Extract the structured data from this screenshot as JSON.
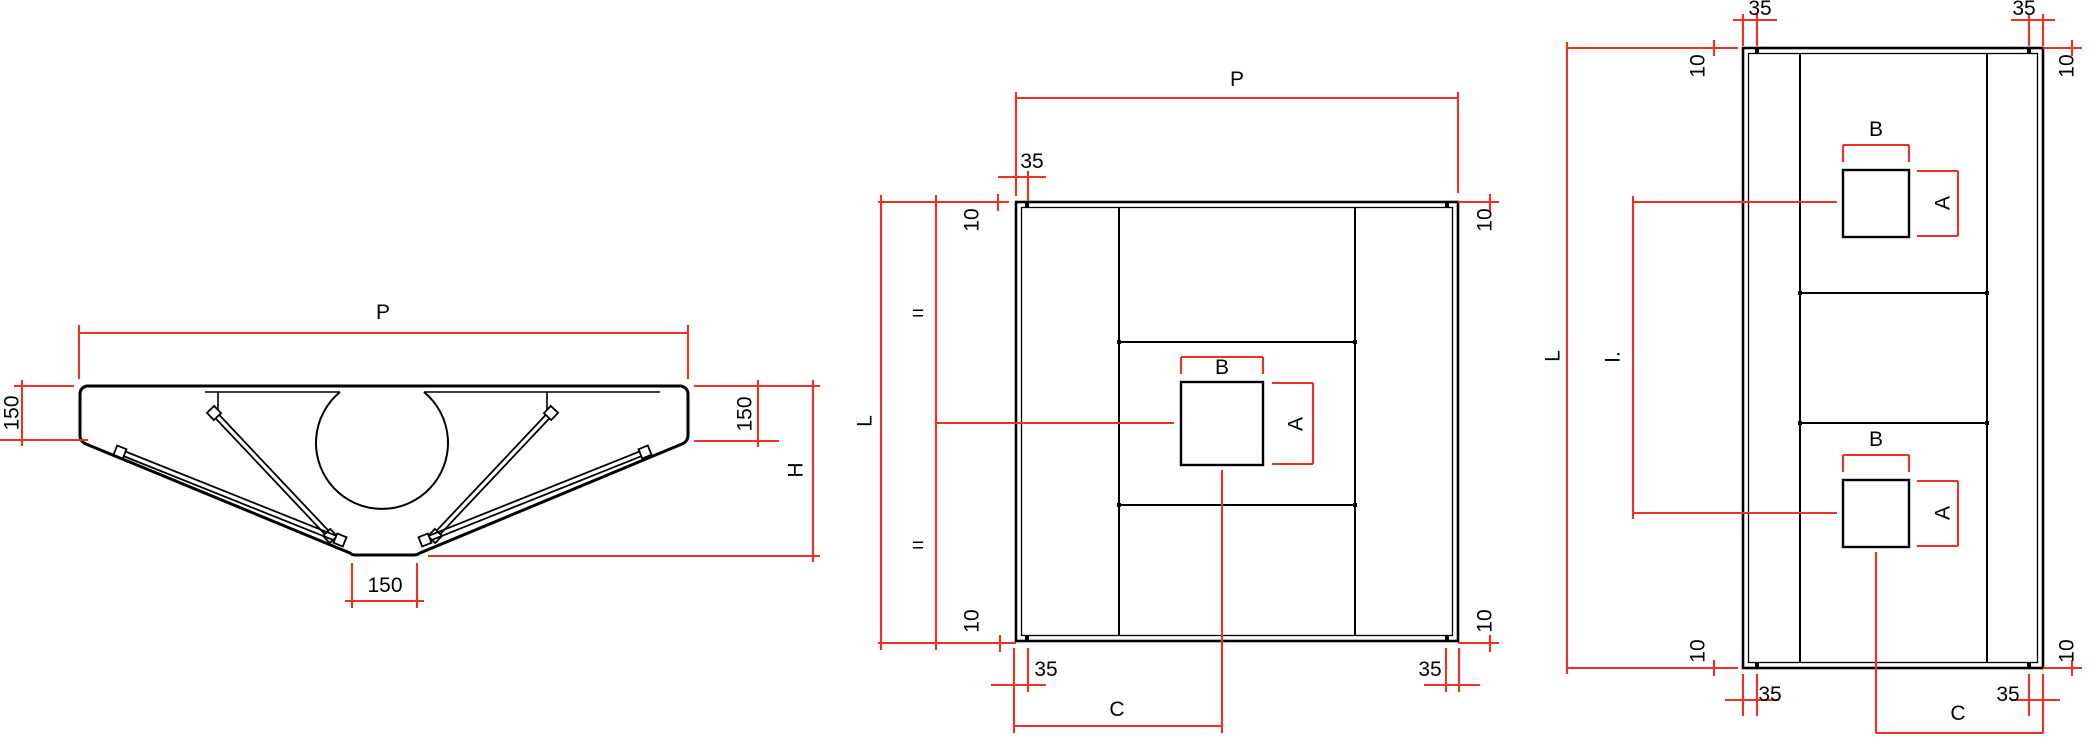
{
  "meta": {
    "description": "Technical dimension drawing: extraction hood front section and two plan views"
  },
  "colors": {
    "line": "#000000",
    "dimension": "#ee3124",
    "background": "#ffffff",
    "label_text": "#000000"
  },
  "canvas": {
    "width": 2094,
    "height": 737
  },
  "labels": [
    {
      "name": "dim-p-front",
      "text": "P",
      "x": 383,
      "y": 319,
      "rot": 0
    },
    {
      "name": "dim-150-front-left",
      "text": "150",
      "x": 11,
      "y": 413,
      "rot": -90
    },
    {
      "name": "dim-150-front-right",
      "text": "150",
      "x": 744,
      "y": 414,
      "rot": -90
    },
    {
      "name": "dim-h-front",
      "text": "H",
      "x": 795,
      "y": 470,
      "rot": -90
    },
    {
      "name": "dim-150-front-bottom",
      "text": "150",
      "x": 385,
      "y": 592,
      "rot": 0
    },
    {
      "name": "dim-p-plan",
      "text": "P",
      "x": 1237,
      "y": 86,
      "rot": 0
    },
    {
      "name": "dim-35-plan-top-left",
      "text": "35",
      "x": 1032,
      "y": 168,
      "rot": 0
    },
    {
      "name": "dim-10-plan-top-left",
      "text": "10",
      "x": 971,
      "y": 220,
      "rot": -90
    },
    {
      "name": "dim-10-plan-top-right",
      "text": "10",
      "x": 1484,
      "y": 220,
      "rot": -90
    },
    {
      "name": "dim-l-plan",
      "text": "L",
      "x": 864,
      "y": 421,
      "rot": -90
    },
    {
      "name": "dim-eq-plan-upper",
      "text": "=",
      "x": 918,
      "y": 320,
      "rot": 0
    },
    {
      "name": "dim-eq-plan-lower",
      "text": "=",
      "x": 918,
      "y": 552,
      "rot": 0
    },
    {
      "name": "dim-b-plan",
      "text": "B",
      "x": 1222,
      "y": 374,
      "rot": 0
    },
    {
      "name": "dim-a-plan",
      "text": "A",
      "x": 1295,
      "y": 424,
      "rot": -90
    },
    {
      "name": "dim-10-plan-bottom-left",
      "text": "10",
      "x": 971,
      "y": 621,
      "rot": -90
    },
    {
      "name": "dim-10-plan-bottom-right",
      "text": "10",
      "x": 1484,
      "y": 621,
      "rot": -90
    },
    {
      "name": "dim-35-plan-bottom-left",
      "text": "35",
      "x": 1046,
      "y": 676,
      "rot": 0
    },
    {
      "name": "dim-35-plan-bottom-right",
      "text": "35",
      "x": 1430,
      "y": 676,
      "rot": 0
    },
    {
      "name": "dim-c-plan",
      "text": "C",
      "x": 1117,
      "y": 716,
      "rot": 0
    },
    {
      "name": "dim-35-plan2-top-left",
      "text": "35",
      "x": 1760,
      "y": 15,
      "rot": 0
    },
    {
      "name": "dim-35-plan2-top-right",
      "text": "35",
      "x": 2024,
      "y": 15,
      "rot": 0
    },
    {
      "name": "dim-10-plan2-top-left",
      "text": "10",
      "x": 1697,
      "y": 66,
      "rot": -90
    },
    {
      "name": "dim-10-plan2-top-right",
      "text": "10",
      "x": 2066,
      "y": 66,
      "rot": -90
    },
    {
      "name": "dim-l-plan2",
      "text": "L",
      "x": 1552,
      "y": 356,
      "rot": -90
    },
    {
      "name": "dim-i-plan2",
      "text": "I.",
      "x": 1612,
      "y": 357,
      "rot": -90
    },
    {
      "name": "dim-b-plan2-upper",
      "text": "B",
      "x": 1876,
      "y": 136,
      "rot": 0
    },
    {
      "name": "dim-a-plan2-upper",
      "text": "A",
      "x": 1942,
      "y": 203,
      "rot": -90
    },
    {
      "name": "dim-b-plan2-lower",
      "text": "B",
      "x": 1876,
      "y": 446,
      "rot": 0
    },
    {
      "name": "dim-a-plan2-lower",
      "text": "A",
      "x": 1942,
      "y": 513,
      "rot": -90
    },
    {
      "name": "dim-10-plan2-bottom-left",
      "text": "10",
      "x": 1697,
      "y": 651,
      "rot": -90
    },
    {
      "name": "dim-10-plan2-bottom-right",
      "text": "10",
      "x": 2066,
      "y": 651,
      "rot": -90
    },
    {
      "name": "dim-35-plan2-bottom-left",
      "text": "35",
      "x": 1770,
      "y": 701,
      "rot": 0
    },
    {
      "name": "dim-35-plan2-bottom-right",
      "text": "35",
      "x": 2008,
      "y": 701,
      "rot": 0
    },
    {
      "name": "dim-c-plan2",
      "text": "C",
      "x": 1958,
      "y": 720,
      "rot": 0
    }
  ],
  "black": {
    "paths": [
      {
        "name": "hood-outline",
        "d": "M 87,386 L 680,386 A 8 8 0 0 1 688,394 L 688,436 A 9 9 0 0 1 682,444 L 420,553 Q 417,555 414,555 L 355,555 Q 352,555 350,553 L 86,444 A 9 9 0 0 1 80,436 L 80,394 A 8 8 0 0 1 87,386 Z",
        "sw": 3
      },
      {
        "name": "duct-collar-arc",
        "d": "M 340,392 A 66 66 0 1 0 424,392",
        "sw": 2
      }
    ],
    "rects": [
      {
        "name": "plan-hood-outer",
        "x": 1016,
        "y": 202,
        "w": 442,
        "h": 439,
        "sw": 2.6
      },
      {
        "name": "plan-hood-inner-flange",
        "x": 1021.5,
        "y": 207.5,
        "w": 431,
        "h": 428,
        "sw": 1.3
      },
      {
        "name": "plan-duct-square",
        "x": 1181,
        "y": 382,
        "w": 82,
        "h": 83,
        "sw": 2.4
      },
      {
        "name": "plan2-hood-outer",
        "x": 1743,
        "y": 48,
        "w": 300,
        "h": 620,
        "sw": 2.6
      },
      {
        "name": "plan2-hood-inner-flange",
        "x": 1748.5,
        "y": 53.5,
        "w": 289,
        "h": 609,
        "sw": 1.3
      },
      {
        "name": "plan2-duct-square-upper",
        "x": 1843,
        "y": 170,
        "w": 66,
        "h": 67,
        "sw": 2.4
      },
      {
        "name": "plan2-duct-square-lower",
        "x": 1843,
        "y": 480,
        "w": 66,
        "h": 67,
        "sw": 2.4
      }
    ],
    "lines": [
      {
        "name": "plan-filter-wall-left",
        "x1": 1119,
        "y1": 207,
        "x2": 1119,
        "y2": 636,
        "sw": 2
      },
      {
        "name": "plan-filter-wall-right",
        "x1": 1355,
        "y1": 207,
        "x2": 1355,
        "y2": 636,
        "sw": 2
      },
      {
        "name": "plan-band-top",
        "x1": 1119,
        "y1": 342,
        "x2": 1355,
        "y2": 342,
        "sw": 2
      },
      {
        "name": "plan-band-bottom",
        "x1": 1119,
        "y1": 505,
        "x2": 1355,
        "y2": 505,
        "sw": 2
      },
      {
        "name": "plan2-filter-wall-left",
        "x1": 1800,
        "y1": 53,
        "x2": 1800,
        "y2": 663,
        "sw": 2
      },
      {
        "name": "plan2-filter-wall-right",
        "x1": 1987,
        "y1": 53,
        "x2": 1987,
        "y2": 663,
        "sw": 2
      },
      {
        "name": "plan2-band-top",
        "x1": 1800,
        "y1": 293,
        "x2": 1987,
        "y2": 293,
        "sw": 2
      },
      {
        "name": "plan2-band-bottom",
        "x1": 1800,
        "y1": 423,
        "x2": 1987,
        "y2": 423,
        "sw": 2
      },
      {
        "name": "front-inner-top-left",
        "x1": 205,
        "y1": 392,
        "x2": 340,
        "y2": 392,
        "sw": 1.6
      },
      {
        "name": "front-inner-top-right",
        "x1": 424,
        "y1": 392,
        "x2": 660,
        "y2": 392,
        "sw": 1.6
      },
      {
        "name": "front-inner-drop-left",
        "x1": 218,
        "y1": 392,
        "x2": 218,
        "y2": 413,
        "sw": 1.6
      },
      {
        "name": "front-inner-drop-right",
        "x1": 547,
        "y1": 392,
        "x2": 547,
        "y2": 413,
        "sw": 1.6
      }
    ],
    "dots": [
      [
        1119,
        342
      ],
      [
        1355,
        342
      ],
      [
        1119,
        505
      ],
      [
        1355,
        505
      ],
      [
        1800,
        293
      ],
      [
        1987,
        293
      ],
      [
        1800,
        423
      ],
      [
        1987,
        423
      ],
      [
        1027,
        205
      ],
      [
        1447,
        205
      ],
      [
        1027,
        638
      ],
      [
        1447,
        638
      ],
      [
        1757,
        51
      ],
      [
        2029,
        51
      ],
      [
        1757,
        665
      ],
      [
        2029,
        665
      ]
    ],
    "filters": [
      {
        "name": "filter-steep-left",
        "x1": 214,
        "y1": 413,
        "x2": 330,
        "y2": 536
      },
      {
        "name": "filter-steep-right",
        "x1": 551,
        "y1": 413,
        "x2": 435,
        "y2": 536
      },
      {
        "name": "filter-shallow-left",
        "x1": 120,
        "y1": 452,
        "x2": 340,
        "y2": 540
      },
      {
        "name": "filter-shallow-right",
        "x1": 645,
        "y1": 452,
        "x2": 425,
        "y2": 540
      }
    ]
  },
  "red_segments": [
    [
      79,
      325,
      79,
      379
    ],
    [
      688,
      325,
      688,
      379
    ],
    [
      79,
      333,
      688,
      333
    ],
    [
      14,
      386,
      74,
      386
    ],
    [
      0,
      440,
      88,
      440
    ],
    [
      22,
      380,
      22,
      446
    ],
    [
      694,
      386,
      820,
      386
    ],
    [
      694,
      441,
      779,
      441
    ],
    [
      758,
      380,
      758,
      447
    ],
    [
      428,
      556,
      820,
      556
    ],
    [
      813,
      380,
      813,
      562
    ],
    [
      352,
      563,
      352,
      608
    ],
    [
      417,
      563,
      417,
      608
    ],
    [
      345,
      601,
      424,
      601
    ],
    [
      1016,
      92,
      1016,
      196
    ],
    [
      1458,
      92,
      1458,
      193
    ],
    [
      1016,
      98,
      1458,
      98
    ],
    [
      1028,
      171,
      1028,
      201
    ],
    [
      998,
      177,
      1046,
      177
    ],
    [
      878,
      202,
      1009,
      202
    ],
    [
      998,
      194,
      998,
      211
    ],
    [
      1458,
      202,
      1499,
      202
    ],
    [
      1490,
      194,
      1490,
      211
    ],
    [
      881,
      195,
      881,
      650
    ],
    [
      936,
      195,
      936,
      650
    ],
    [
      936,
      423,
      1174,
      423
    ],
    [
      1222,
      470,
      1222,
      733
    ],
    [
      1181,
      357,
      1263,
      357
    ],
    [
      1181,
      357,
      1181,
      374
    ],
    [
      1263,
      357,
      1263,
      374
    ],
    [
      1313,
      383,
      1313,
      464
    ],
    [
      1272,
      383,
      1313,
      383
    ],
    [
      1272,
      464,
      1313,
      464
    ],
    [
      878,
      643,
      1016,
      643
    ],
    [
      1000,
      635,
      1000,
      652
    ],
    [
      1458,
      643,
      1499,
      643
    ],
    [
      1490,
      635,
      1490,
      652
    ],
    [
      1014,
      648,
      1014,
      733
    ],
    [
      1028,
      648,
      1028,
      692
    ],
    [
      991,
      685,
      1046,
      685
    ],
    [
      1446,
      648,
      1446,
      692
    ],
    [
      1459,
      648,
      1459,
      692
    ],
    [
      1424,
      685,
      1480,
      685
    ],
    [
      1014,
      726,
      1222,
      726
    ],
    [
      1743,
      14,
      1743,
      46
    ],
    [
      1757,
      14,
      1757,
      46
    ],
    [
      1733,
      20,
      1777,
      20
    ],
    [
      2029,
      14,
      2029,
      46
    ],
    [
      2043,
      14,
      2043,
      46
    ],
    [
      2011,
      20,
      2055,
      20
    ],
    [
      1567,
      48,
      1738,
      48
    ],
    [
      1714,
      40,
      1714,
      56
    ],
    [
      2043,
      48,
      2082,
      48
    ],
    [
      2072,
      40,
      2072,
      56
    ],
    [
      1567,
      42,
      1567,
      674
    ],
    [
      1633,
      196,
      1633,
      519
    ],
    [
      1633,
      202,
      1837,
      202
    ],
    [
      1633,
      513,
      1837,
      513
    ],
    [
      1843,
      145,
      1909,
      145
    ],
    [
      1843,
      145,
      1843,
      162
    ],
    [
      1909,
      145,
      1909,
      162
    ],
    [
      1958,
      171,
      1958,
      236
    ],
    [
      1917,
      171,
      1958,
      171
    ],
    [
      1917,
      236,
      1958,
      236
    ],
    [
      1843,
      455,
      1909,
      455
    ],
    [
      1843,
      455,
      1843,
      472
    ],
    [
      1909,
      455,
      1909,
      472
    ],
    [
      1958,
      481,
      1958,
      546
    ],
    [
      1917,
      481,
      1958,
      481
    ],
    [
      1917,
      546,
      1958,
      546
    ],
    [
      1876,
      552,
      1876,
      733
    ],
    [
      1567,
      668,
      1738,
      668
    ],
    [
      1714,
      660,
      1714,
      676
    ],
    [
      2043,
      668,
      2082,
      668
    ],
    [
      2072,
      660,
      2072,
      676
    ],
    [
      1743,
      674,
      1743,
      716
    ],
    [
      1757,
      674,
      1757,
      716
    ],
    [
      1725,
      700,
      1779,
      700
    ],
    [
      2029,
      674,
      2029,
      716
    ],
    [
      2043,
      674,
      2043,
      733
    ],
    [
      2011,
      700,
      2060,
      700
    ],
    [
      1876,
      733,
      2043,
      733
    ]
  ]
}
